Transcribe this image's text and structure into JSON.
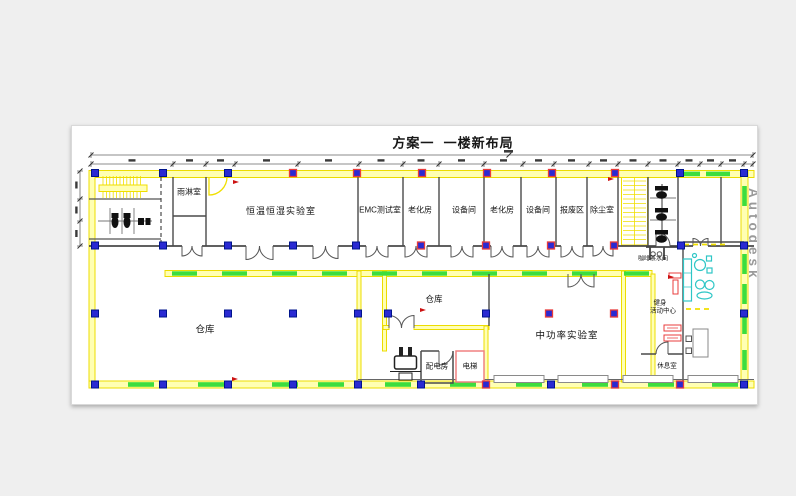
{
  "title": "方案一  一楼新布局",
  "watermark": "Autodesk",
  "rooms": {
    "rain": "雨淋室",
    "thermo": "恒温恒湿实验室",
    "emc": "EMC测试室",
    "aging1": "老化房",
    "equip1": "设备间",
    "aging2": "老化房",
    "equip2": "设备间",
    "scrap": "报废区",
    "dust": "除尘室",
    "warehouse_main": "仓库",
    "warehouse_small": "仓库",
    "mid_power": "中功率实验室",
    "power_dist": "配电房",
    "elevator": "电梯",
    "coffee": "咖啡茶水间",
    "fitness_line1": "健身",
    "fitness_line2": "活动中心",
    "rest": "休息室"
  },
  "colors": {
    "wall_yellow": "#f0df00",
    "wall_fill": "#ffffb3",
    "safety_green": "#3ddd3d",
    "column_blue": "#2a2ad2",
    "alert_red": "#e83c3c",
    "furniture_cyan": "#2ec6c6"
  }
}
